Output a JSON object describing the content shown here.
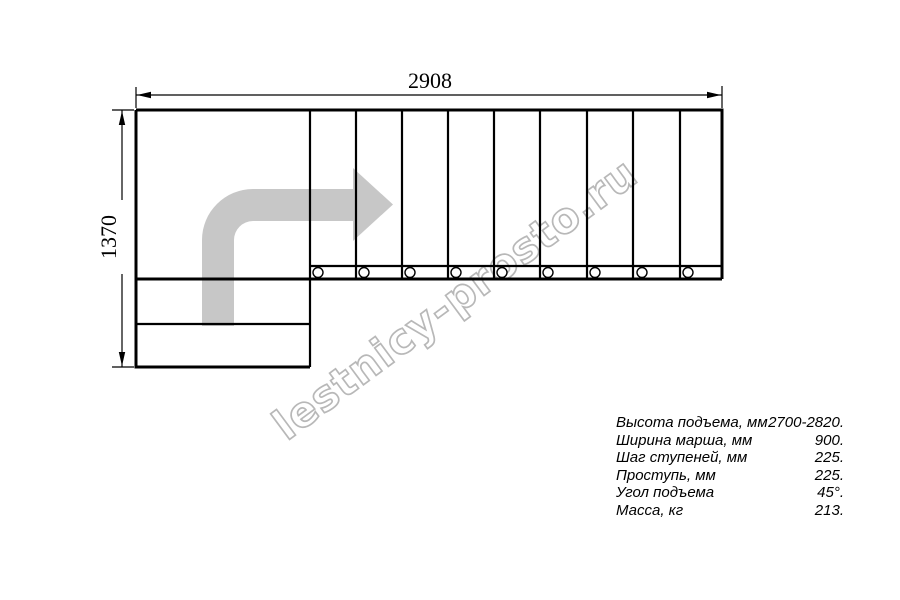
{
  "drawing": {
    "type": "staircase-plan-top-view",
    "dim_width_mm": "2908",
    "dim_height_mm": "1370",
    "upper_flight_treads": 9,
    "lower_flight_steps": 2,
    "tread_marker_count": 9,
    "colors": {
      "line": "#000000",
      "arrow_fill": "#c7c7c7",
      "watermark_outline": "#b5b5b5"
    }
  },
  "watermark": {
    "text": "lestnicy-prosto.ru"
  },
  "specs": {
    "rows": [
      {
        "label": "Высота подъема, мм",
        "value": "2700-2820."
      },
      {
        "label": "Ширина марша, мм",
        "value": "900."
      },
      {
        "label": "Шаг ступеней, мм",
        "value": "225."
      },
      {
        "label": "Проступь, мм",
        "value": "225."
      },
      {
        "label": "Угол подъема",
        "value": "45°."
      },
      {
        "label": "Масса, кг",
        "value": "213."
      }
    ]
  }
}
